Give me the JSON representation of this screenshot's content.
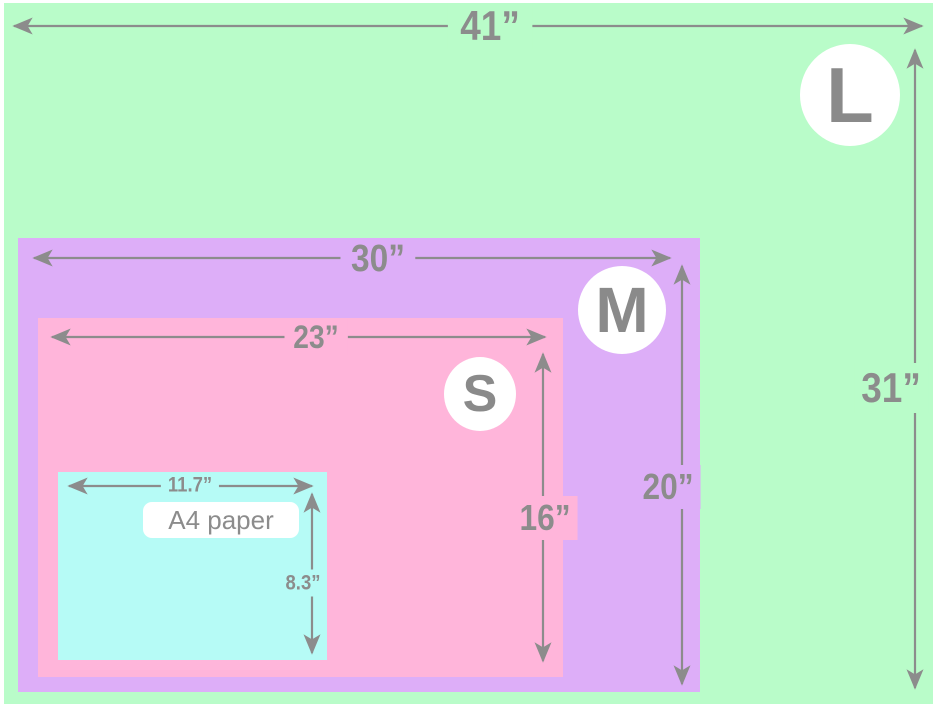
{
  "diagram": {
    "type": "nested-size-comparison",
    "colors": {
      "size_l_bg": "#b9fcc9",
      "size_m_bg": "#ddaef8",
      "size_s_bg": "#ffb5da",
      "a4_bg": "#b6fbf6",
      "dimension_gray": "#8c8c8c",
      "badge_bg": "#ffffff",
      "badge_text": "#8a8a8a"
    },
    "sizes": [
      {
        "code": "L",
        "width_label": "41”",
        "height_label": "31”"
      },
      {
        "code": "M",
        "width_label": "30”",
        "height_label": "20”"
      },
      {
        "code": "S",
        "width_label": "23”",
        "height_label": "16”"
      },
      {
        "code": "A4",
        "name": "A4 paper",
        "width_label": "11.7”",
        "height_label": "8.3”"
      }
    ]
  }
}
